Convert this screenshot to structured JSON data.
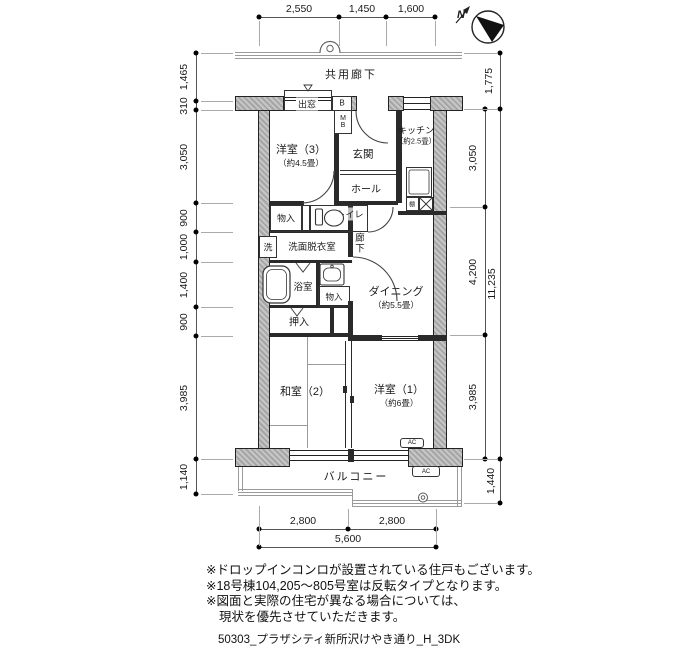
{
  "title": "間取り図",
  "compass": {
    "n": "N"
  },
  "dims": {
    "top": [
      "2,550",
      "1,450",
      "1,600"
    ],
    "left": [
      "1,465",
      "310",
      "3,050",
      "900",
      "1,000",
      "1,400",
      "900",
      "3,985",
      "1,140"
    ],
    "right_inner": [
      "3,050",
      "4,200",
      "3,985"
    ],
    "right_outer": [
      "1,775",
      "11,235",
      "1,440"
    ],
    "bottom": [
      "2,800",
      "2,800",
      "5,600"
    ]
  },
  "rooms": {
    "common_corridor": "共用廊下",
    "bay_window": "出窓",
    "b_box": "B",
    "meter_box": "MB",
    "western3": "洋室（3）",
    "western3_size": "（約4.5畳）",
    "entrance": "玄関",
    "kitchen": "キッチン",
    "kitchen_size": "（約2.5畳）",
    "hall": "ホール",
    "storage_top": "物入",
    "toilet": "トイレ",
    "washer": "洗",
    "washroom": "洗面脱衣室",
    "corridor": "廊下",
    "bathroom": "浴室",
    "storage_mid": "物入",
    "closet": "押入",
    "dining": "ダイニング",
    "dining_size": "（約5.5畳）",
    "japanese2": "和室（2）",
    "western1": "洋室（1）",
    "western1_size": "（約6畳）",
    "balcony": "バルコニー",
    "shelf": "棚",
    "ac_unit": "AC",
    "ac_balcony": "AC"
  },
  "notes": [
    "※ドロップインコンロが設置されている住戸もございます。",
    "※18号棟104,205～805号室は反転タイプとなります。",
    "※図面と実際の住宅が異なる場合については、",
    "現状を優先させていただきます。"
  ],
  "footer": "50303_プラザシティ新所沢けやき通り_H_3DK"
}
